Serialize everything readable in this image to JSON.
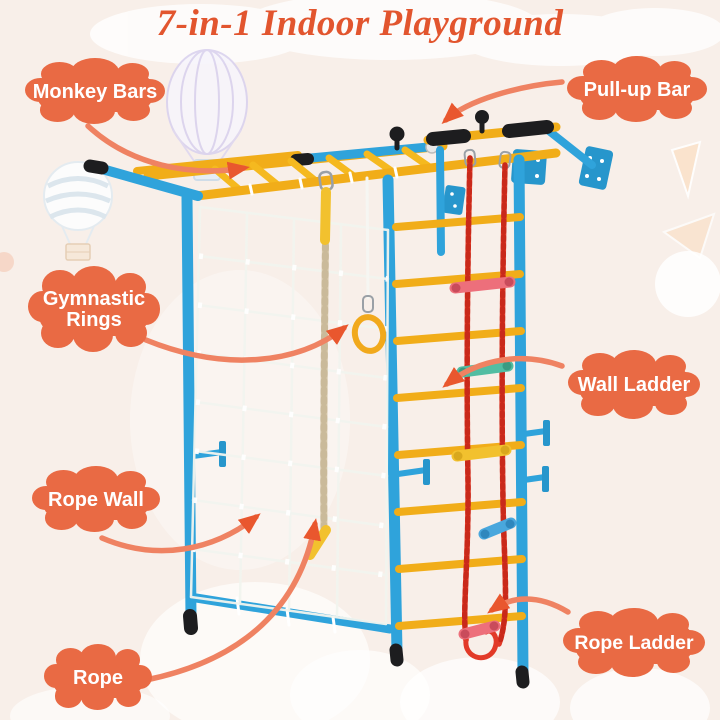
{
  "title": {
    "text": "7-in-1 Indoor Playground"
  },
  "callouts": {
    "monkey_bars": "Monkey Bars",
    "pull_up_bar": "Pull-up Bar",
    "gymnastic_rings": "Gymnastic Rings",
    "wall_ladder": "Wall Ladder",
    "rope_wall": "Rope Wall",
    "rope": "Rope",
    "rope_ladder": "Rope Ladder"
  },
  "colors": {
    "background": "#f8efe9",
    "title_text": "#e2552e",
    "callout_cloud": "#e96a44",
    "arrow": "#ef8262",
    "arrow_head": "#e9572e",
    "frame_blue": "#2fa3db",
    "bar_yellow": "#f1ad19",
    "rope_ladder_red": "#e23a28",
    "climb_rope_beige": "#d7c9ac",
    "grip_black": "#1d1d1f",
    "net_white": "#f2f5ef",
    "rung_pink": "#ed6f7b",
    "rung_teal": "#52bda2",
    "rung_yellow": "#f2c12e",
    "rung_blue": "#49a7dd"
  }
}
